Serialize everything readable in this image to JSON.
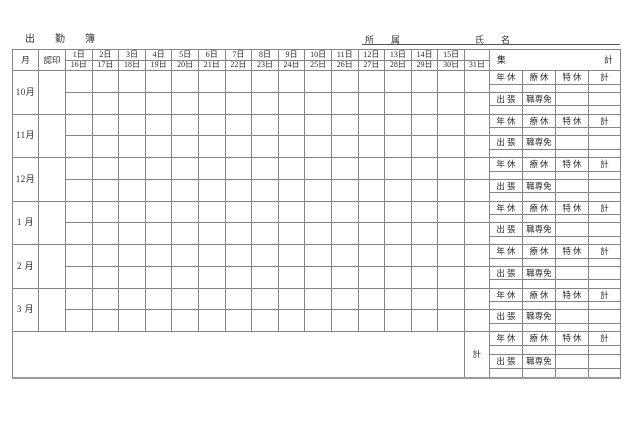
{
  "title": "出　勤　簿",
  "fields": {
    "department_label": "所　属",
    "name_label": "氏　名"
  },
  "table": {
    "month_header": "月",
    "seal_header": "認印",
    "days_top": [
      "1日",
      "2日",
      "3日",
      "4日",
      "5日",
      "6日",
      "7日",
      "8日",
      "9日",
      "10日",
      "11日",
      "12日",
      "13日",
      "14日",
      "15日"
    ],
    "days_bottom": [
      "16日",
      "17日",
      "18日",
      "19日",
      "20日",
      "21日",
      "22日",
      "23日",
      "24日",
      "25日",
      "26日",
      "27日",
      "28日",
      "29日",
      "30日"
    ],
    "day31": "31日",
    "summary": {
      "left": "集",
      "right": "計"
    },
    "months": [
      "10月",
      "11月",
      "12月",
      "1 月",
      "2 月",
      "3 月"
    ],
    "leave_labels": [
      "年 休",
      "療 休",
      "特 休",
      "計"
    ],
    "duty_labels": [
      "出 張",
      "職専免"
    ],
    "grand_total_label": "計"
  }
}
